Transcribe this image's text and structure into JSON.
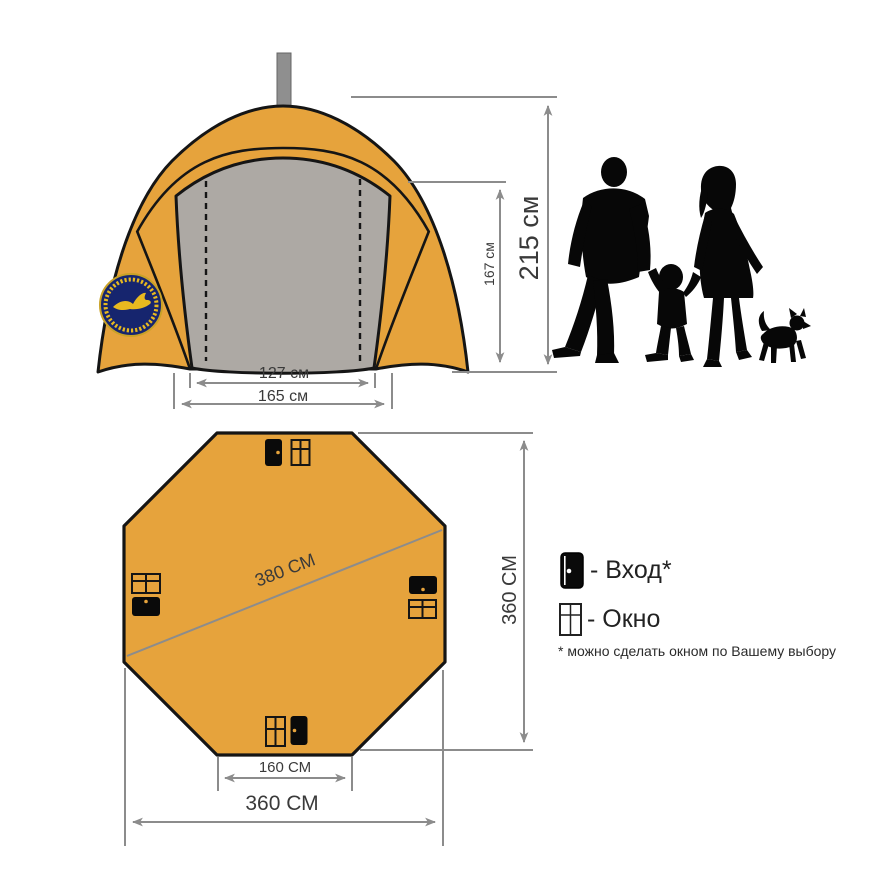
{
  "front_view": {
    "inner_width": "127 см",
    "outer_width": "165 см",
    "inner_height": "167 см",
    "total_height": "215 см"
  },
  "plan_view": {
    "diagonal": "380 СМ",
    "height": "360 СМ",
    "entrance_width": "160 СМ",
    "width": "360 СМ"
  },
  "legend": {
    "entrance": "- Вход*",
    "window": "- Окно",
    "footnote": "* можно сделать окном по Вашему выбору"
  },
  "icons": {
    "door": "door-icon (black leaf with knob dot)",
    "window": "window-icon (four-pane cross)",
    "chimney": "chimney-pipe-icon",
    "logo": "brand-badge-icon (navy circle, yellow bird)",
    "family": "family-scale-silhouette (man, child, woman, dog)"
  },
  "colors": {
    "tent_orange": "#E6A33C",
    "panel_gray": "#ADA9A4",
    "outline_black": "#151515",
    "dimension_gray": "#8C8C8C",
    "text_dark": "#3A3A3A",
    "logo_navy": "#16256E",
    "logo_yellow": "#E8B91F"
  }
}
